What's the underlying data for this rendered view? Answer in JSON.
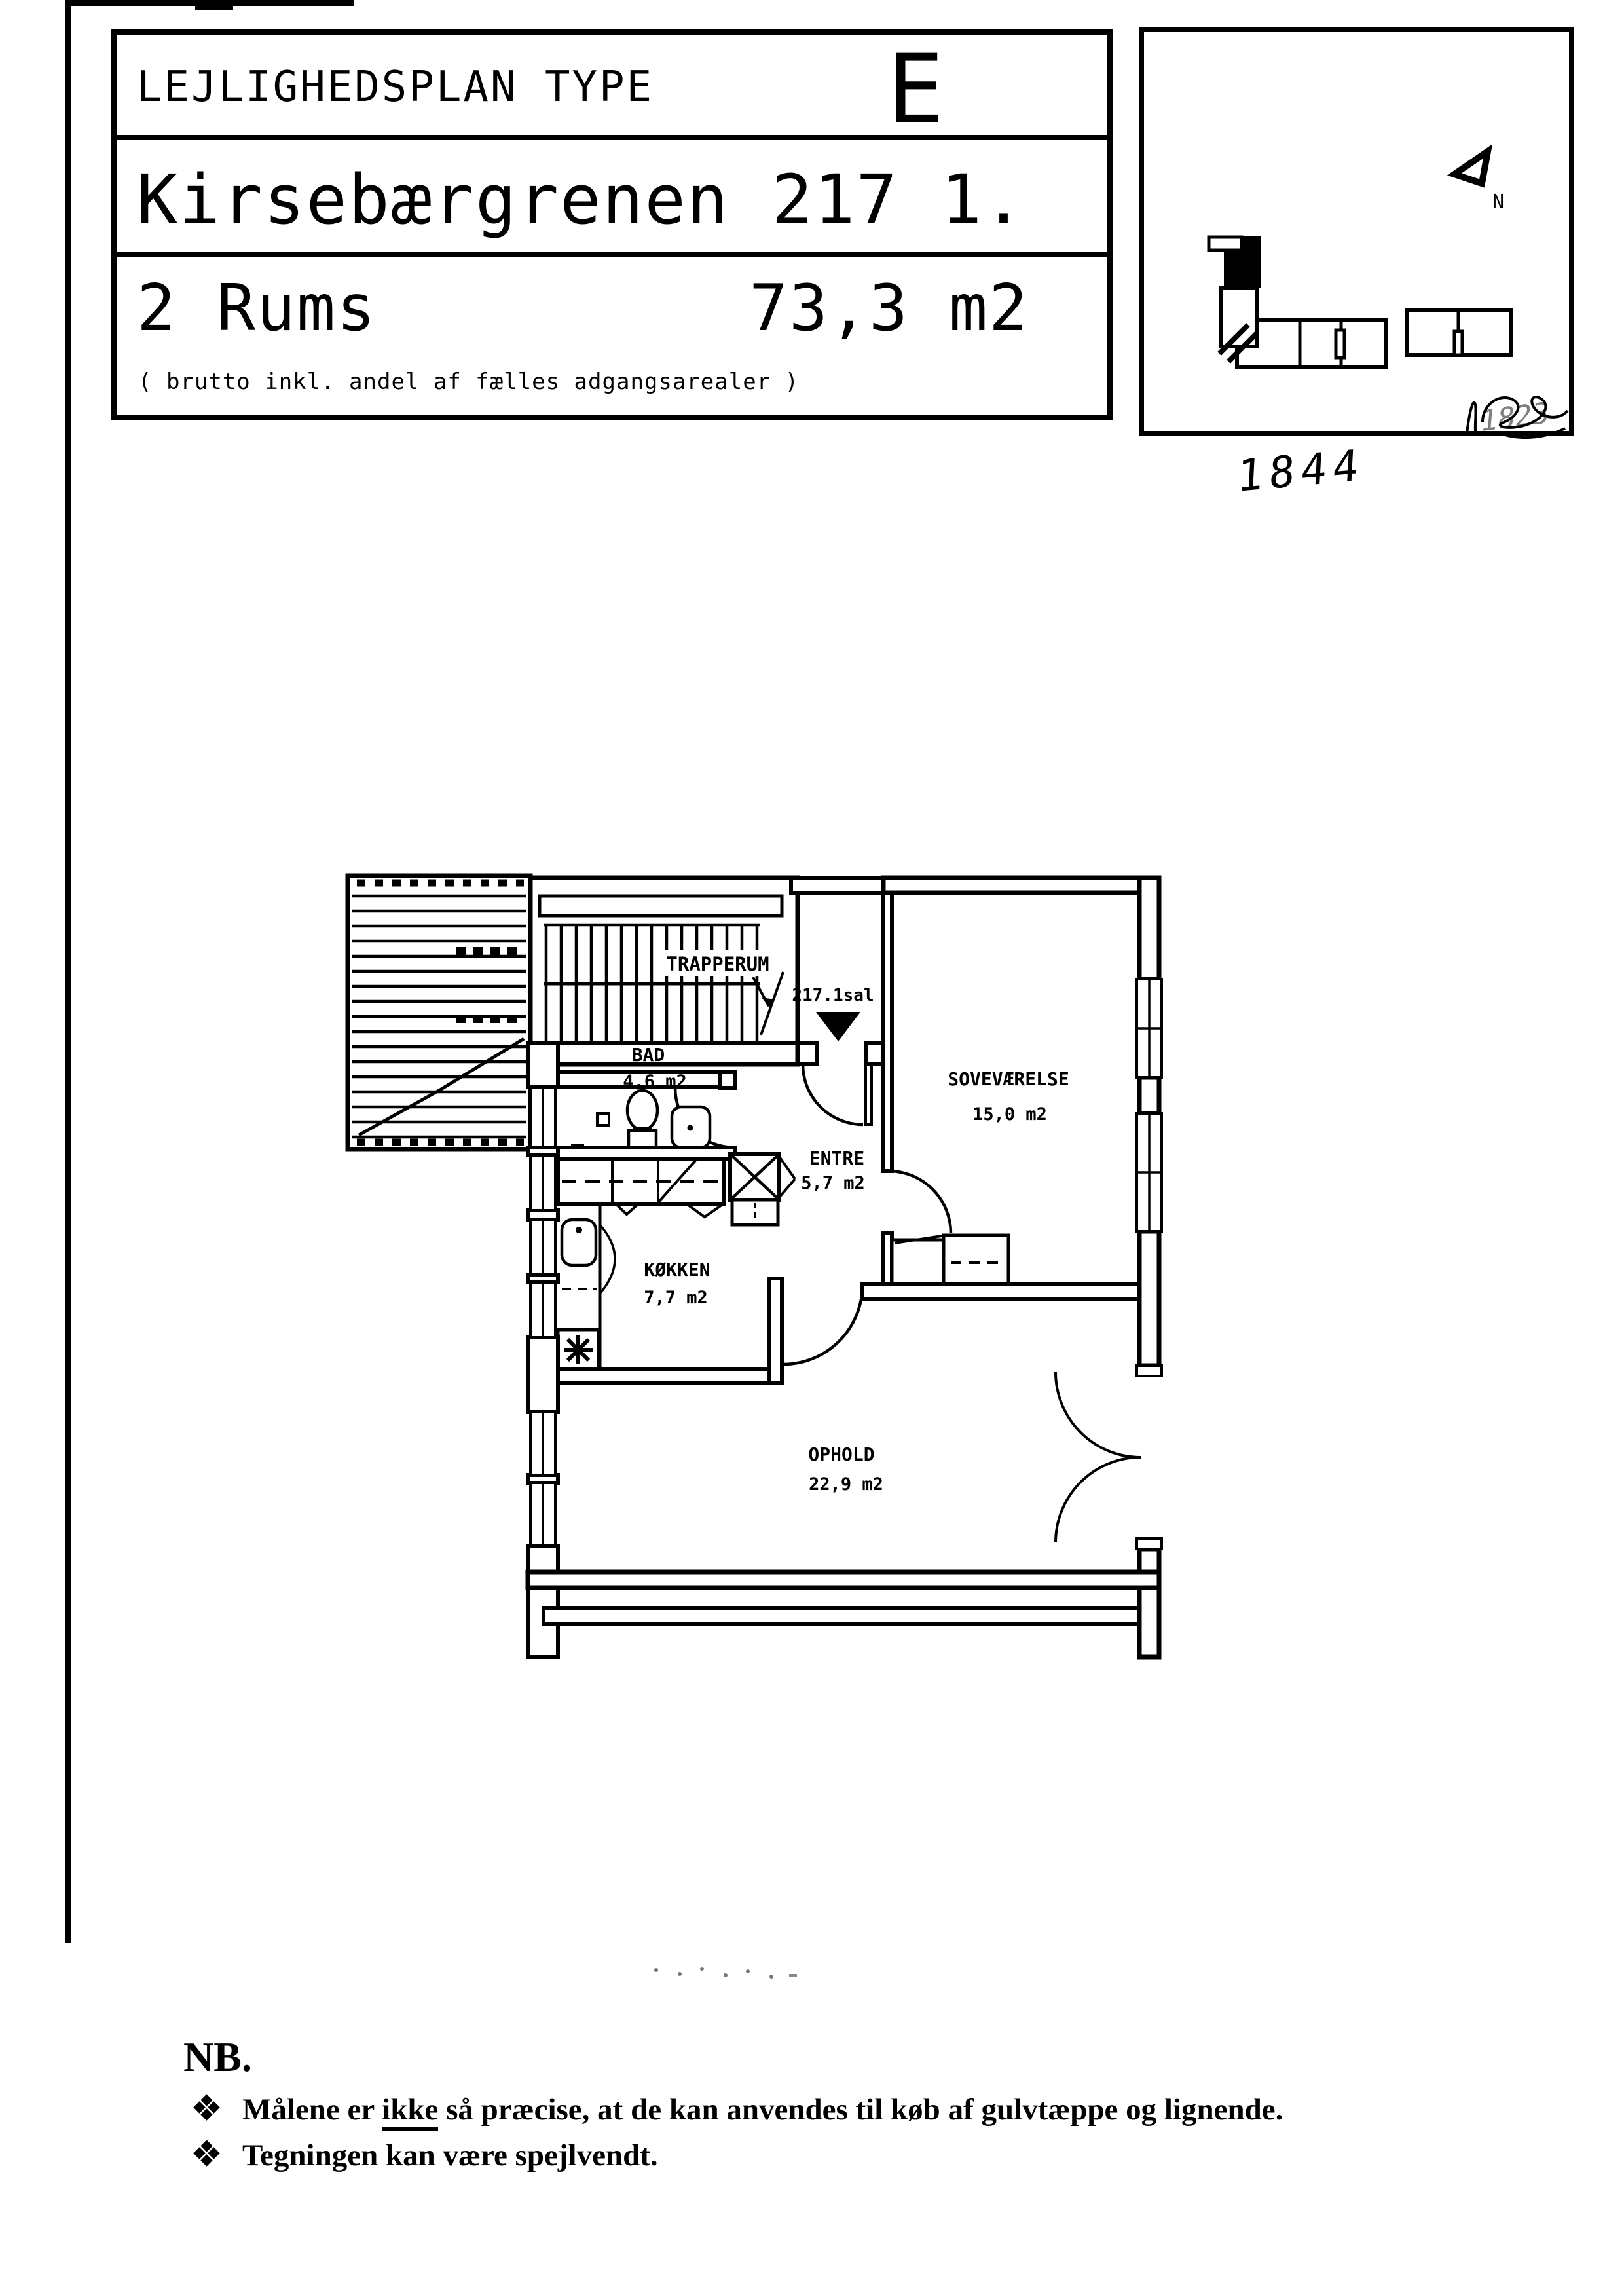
{
  "page": {
    "paper": "#ffffff",
    "ink": "#000000"
  },
  "title_block": {
    "type_label": "LEJLIGHEDSPLAN TYPE",
    "type_value": "E",
    "address": "Kirsebærgrenen 217 1.",
    "rooms_label": "2 Rums",
    "area_value": "73,3 m2",
    "area_note": "( brutto inkl. andel af fælles adgangsarealer )"
  },
  "site_plan": {
    "north_label": "N",
    "handwritten_year": "1844",
    "handwritten_scribble": "1823"
  },
  "floor_plan": {
    "stair_label": "TRAPPERUM",
    "entrance_label": "217.1sal",
    "rooms": {
      "bad": {
        "name": "BAD",
        "area": "4,6 m2"
      },
      "entre": {
        "name": "ENTRE",
        "area": "5,7 m2"
      },
      "sovevaerelse": {
        "name": "SOVEVÆRELSE",
        "area": "15,0 m2"
      },
      "koekken": {
        "name": "KØKKEN",
        "area": "7,7 m2"
      },
      "ophold": {
        "name": "OPHOLD",
        "area": "22,9 m2"
      }
    }
  },
  "notes": {
    "heading": "NB.",
    "item1": {
      "prefix": "Målene er ",
      "underline": "ikke",
      "suffix": " så præcise, at de kan anvendes til køb af gulvtæppe og lignende."
    },
    "item2": {
      "text": "Tegningen kan være spejlvendt."
    }
  }
}
